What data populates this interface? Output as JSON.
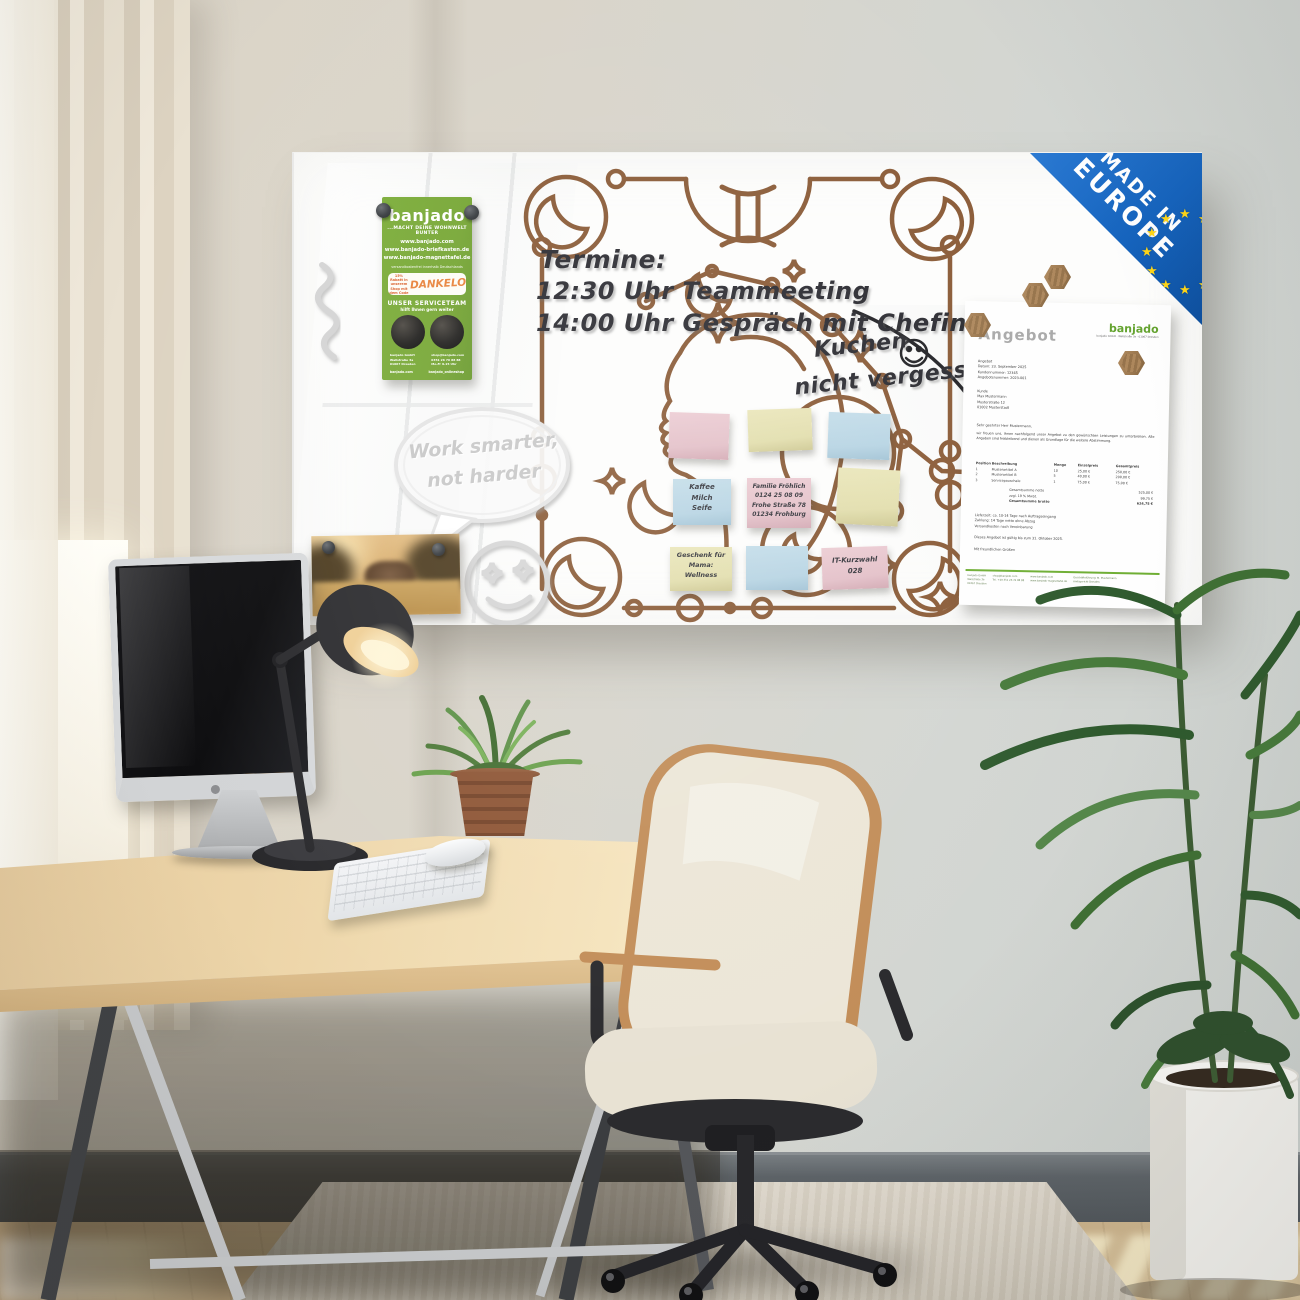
{
  "badge": {
    "line1": "MADE IN",
    "line2": "EUROPE",
    "star": "★"
  },
  "flyer": {
    "brand": "banjado",
    "tagline": "...MACHT DEINE WOHNWELT BUNTER",
    "urls": [
      "www.banjado.com",
      "www.banjado-briefkasten.de",
      "www.banjado-magnettafel.de"
    ],
    "micro": "versandkostenfrei innerhalb Deutschlands",
    "discount_small": "15% Rabatt in unserem Shop mit dem Code",
    "code": "DANKELO",
    "service_title": "UNSER SERVICETEAM",
    "service_sub": "hilft Ihnen gern weiter",
    "contact_left": "banjado GmbH\nWallstraße 3a\n01067 Dresden",
    "contact_right": "shop@banjado.com\n0351 26 76 88 88\nMo-Fr 9-15 Uhr",
    "social_left": "banjado.com",
    "social_right": "banjado_onlineshop"
  },
  "board": {
    "termine_title": "Termine:",
    "termine_line1": "12:30 Uhr Teammeeting",
    "termine_line2": "14:00 Uhr Gespräch mit Chefin",
    "reminder_line1": "Kuchen",
    "reminder_line2": "nicht vergessen",
    "bubble_line1": "Work smarter,",
    "bubble_line2": "not harder"
  },
  "notes": {
    "shopping": "Kaffee\nMilch\nSeife",
    "family": "Familie Fröhlich\n0124 25 08 09\nFrohe Straße 78\n01234 Frohburg",
    "gift": "Geschenk für\nMama:\nWellness",
    "it": "IT-Kurzwahl\n028"
  },
  "document": {
    "title": "Angebot",
    "logo": "banjado",
    "logo_sub": "banjado GmbH · Wallstraße 3a · 01067 Dresden",
    "meta": "Angebot\nDatum: 23. September 2025\nKundennummer: 12345\nAngebotsnummer: 2023-001",
    "kunde": "Kunde\nMax Mustermann\nMusterstraße 12\n01002 Musterstadt",
    "salutation": "Sehr geehrter Herr Mustermann,",
    "body": "wir freuen uns, Ihnen nachfolgend unser Angebot zu den gewünschten Leistungen zu unterbreiten. Alle Angaben sind freibleibend und dienen als Grundlage für die weitere Abstimmung.",
    "table": {
      "headers": [
        "Position",
        "Beschreibung",
        "Menge",
        "Einzelpreis",
        "Gesamtpreis"
      ],
      "rows": [
        [
          "1",
          "Musterartikel A",
          "10",
          "25,00 €",
          "250,00 €"
        ],
        [
          "2",
          "Musterartikel B",
          "5",
          "40,00 €",
          "200,00 €"
        ],
        [
          "3",
          "Servicepauschale",
          "1",
          "75,00 €",
          "75,00 €"
        ]
      ]
    },
    "totals": [
      [
        "Gesamtsumme netto",
        "525,00 €"
      ],
      [
        "zzgl. 19 % MwSt.",
        "99,75 €"
      ],
      [
        "Gesamtsumme brutto",
        "624,75 €"
      ]
    ],
    "terms": "Lieferzeit: ca. 10-14 Tage nach Auftragseingang\nZahlung: 14 Tage netto ohne Abzug\nVersandkosten nach Vereinbarung",
    "validity": "Dieses Angebot ist gültig bis zum 31. Oktober 2025.",
    "closing": "Mit freundlichen Grüßen",
    "footer_col1": "banjado GmbH\nWallstraße 3a\n01067 Dresden",
    "footer_col2": "shop@banjado.com\nTel. +49 351 26 76 88 88",
    "footer_col3": "www.banjado.com\nwww.banjado-magnettafel.de",
    "footer_col4": "Geschäftsführung: M. Mustermann\nAmtsgericht Dresden"
  },
  "colors": {
    "accent_green": "#76a634",
    "eu_blue": "#1563bd",
    "star_yellow": "#ffd617",
    "art_brown": "#8a5b37"
  }
}
